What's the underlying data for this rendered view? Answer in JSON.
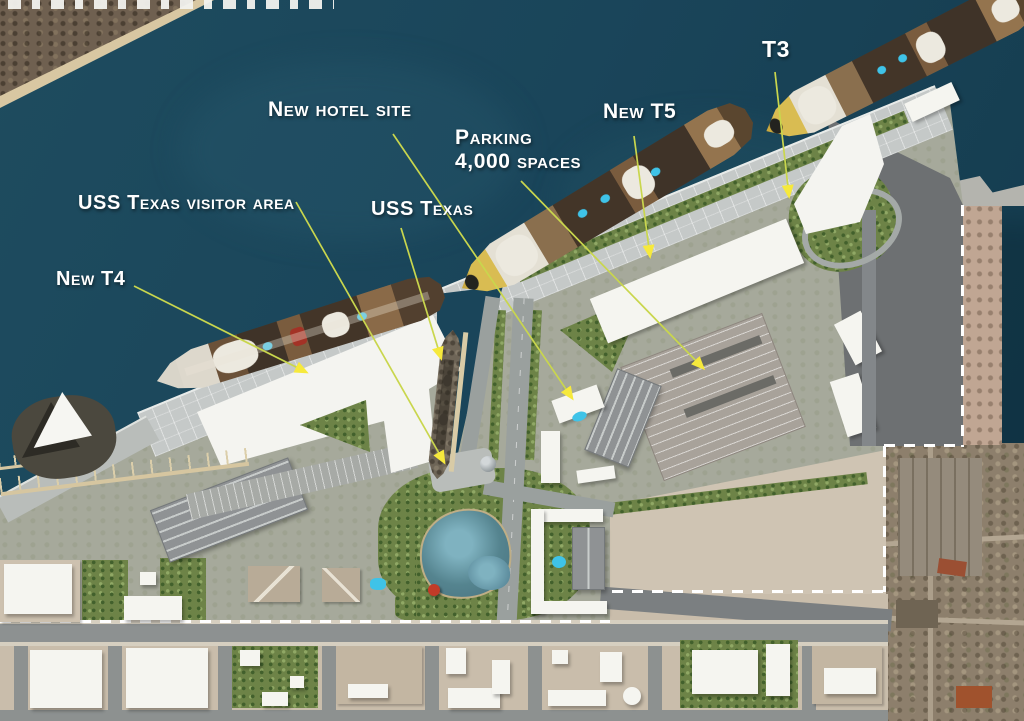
{
  "labels": [
    {
      "id": "new-hotel-site",
      "text": "New hotel site",
      "x": 268,
      "y": 98,
      "size": 21,
      "arrow": {
        "x1": 393,
        "y1": 134,
        "x2": 572,
        "y2": 398
      }
    },
    {
      "id": "parking-4000-spaces",
      "text": "Parking\n4,000 spaces",
      "x": 455,
      "y": 126,
      "size": 21,
      "arrow": {
        "x1": 521,
        "y1": 181,
        "x2": 703,
        "y2": 368
      }
    },
    {
      "id": "new-t5",
      "text": "New T5",
      "x": 603,
      "y": 100,
      "size": 21,
      "arrow": {
        "x1": 634,
        "y1": 136,
        "x2": 650,
        "y2": 256
      }
    },
    {
      "id": "t3",
      "text": "T3",
      "x": 762,
      "y": 36,
      "size": 23,
      "arrow": {
        "x1": 775,
        "y1": 72,
        "x2": 789,
        "y2": 196
      }
    },
    {
      "id": "uss-texas-visitor-area",
      "text": "USS Texas visitor area",
      "x": 78,
      "y": 192,
      "size": 20,
      "arrow": {
        "x1": 296,
        "y1": 202,
        "x2": 444,
        "y2": 462
      }
    },
    {
      "id": "uss-texas",
      "text": "USS Texas",
      "x": 371,
      "y": 198,
      "size": 20,
      "arrow": {
        "x1": 401,
        "y1": 228,
        "x2": 441,
        "y2": 358
      }
    },
    {
      "id": "new-t4",
      "text": "New T4",
      "x": 56,
      "y": 268,
      "size": 20,
      "arrow": {
        "x1": 134,
        "y1": 286,
        "x2": 306,
        "y2": 372
      }
    }
  ],
  "style": {
    "label_color": "#ffffff",
    "arrow_line_color": "#c9d64d",
    "arrow_head_color": "#f6e93c",
    "water_color": "#1a455a"
  }
}
